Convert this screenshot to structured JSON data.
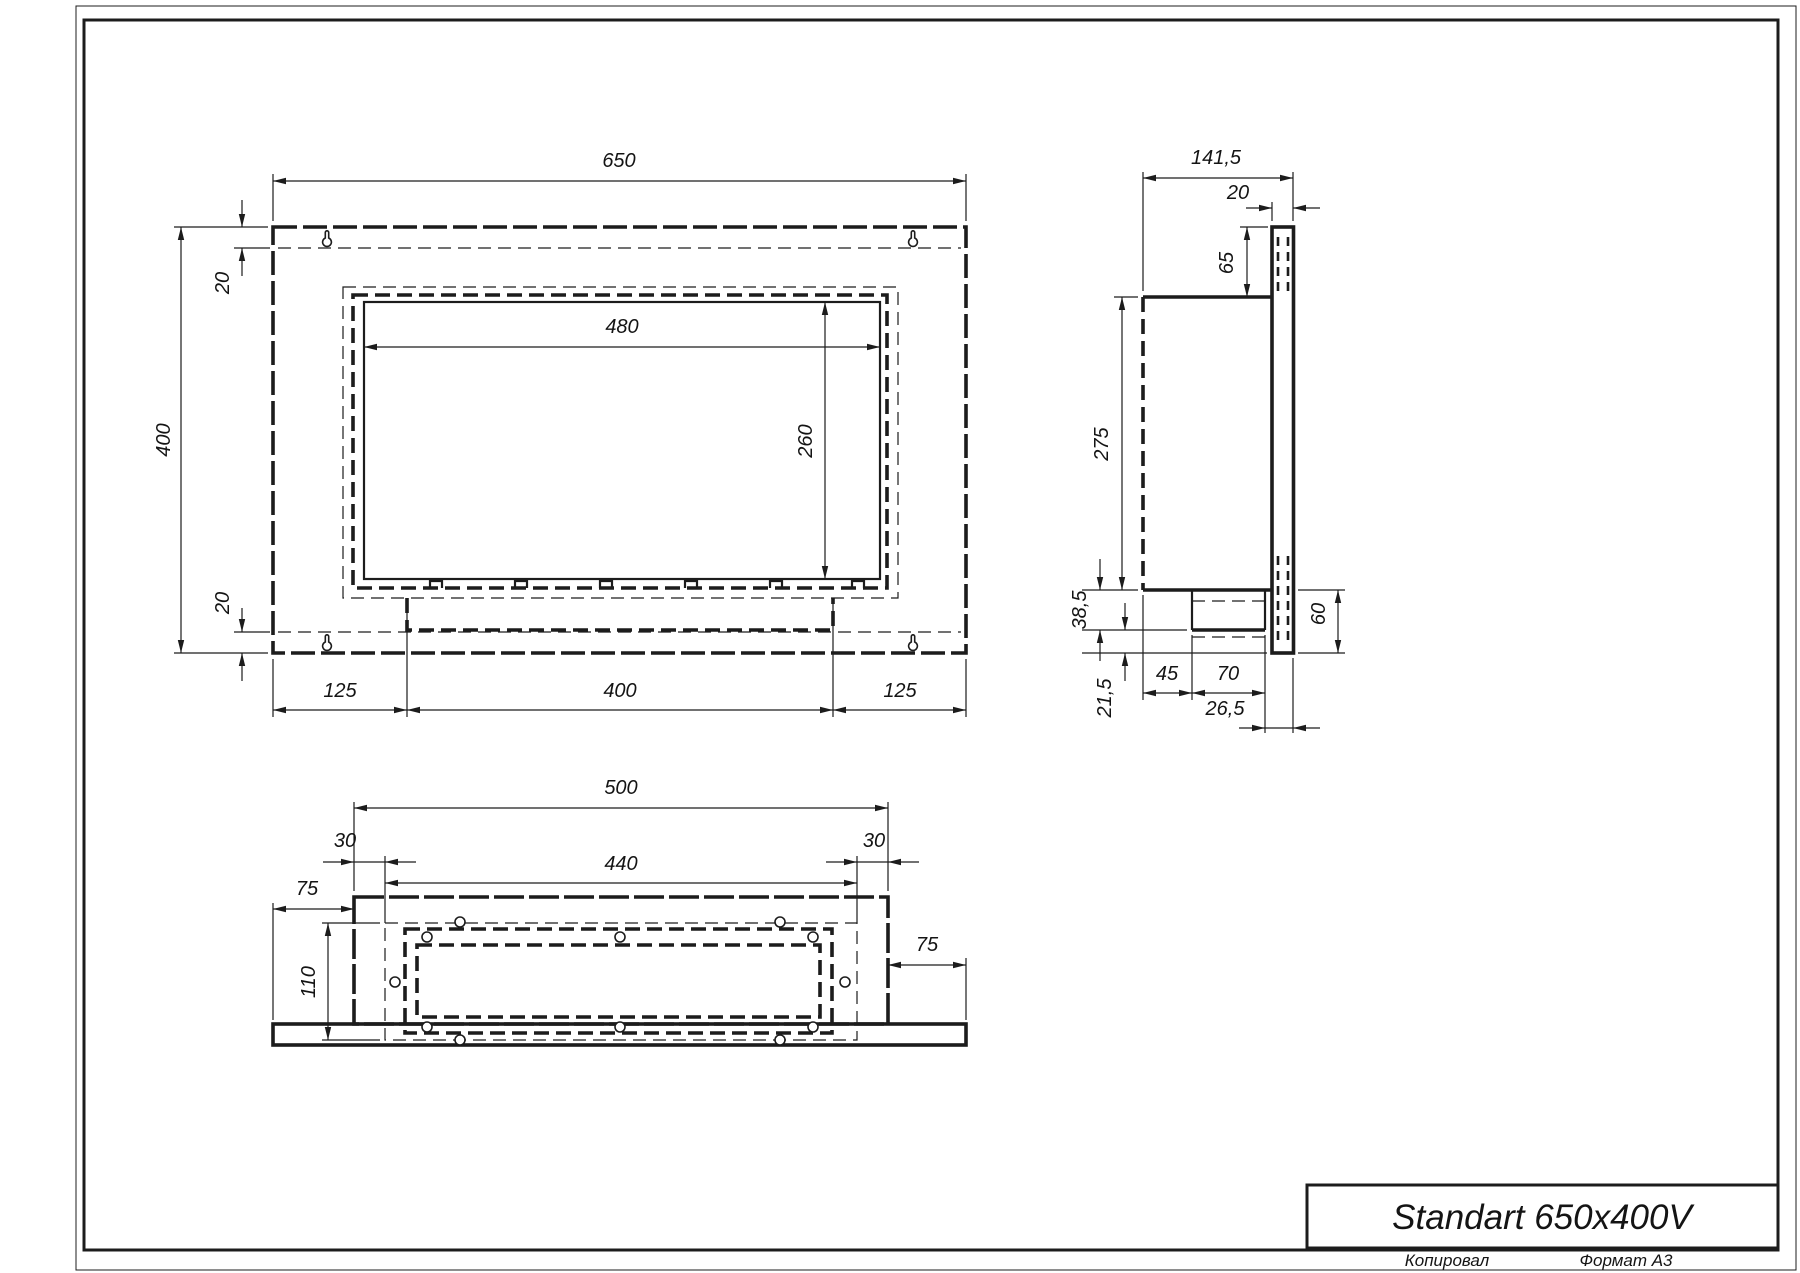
{
  "title_block": {
    "title": "Standart 650x400V",
    "copied_label": "Копировал",
    "format_label": "Формат А3"
  },
  "front_view": {
    "dims": {
      "overall_width": "650",
      "overall_height": "400",
      "top_flange_offset": "20",
      "bottom_flange_offset": "20",
      "opening_width": "480",
      "opening_height": "260",
      "bottom_left_margin": "125",
      "burner_width": "400",
      "bottom_right_margin": "125"
    }
  },
  "side_view": {
    "dims": {
      "overall_depth": "141,5",
      "flange_thickness": "20",
      "top_offset": "65",
      "body_height": "275",
      "burner_drop": "38,5",
      "bottom_gap": "21,5",
      "front_offset": "45",
      "burner_depth": "70",
      "rear_offset": "26,5",
      "flange_bottom_extension": "60"
    }
  },
  "bottom_view": {
    "dims": {
      "body_width": "500",
      "left_inset": "30",
      "cutout_width": "440",
      "right_inset": "30",
      "left_overhang": "75",
      "cutout_depth": "110",
      "right_overhang": "75"
    }
  }
}
